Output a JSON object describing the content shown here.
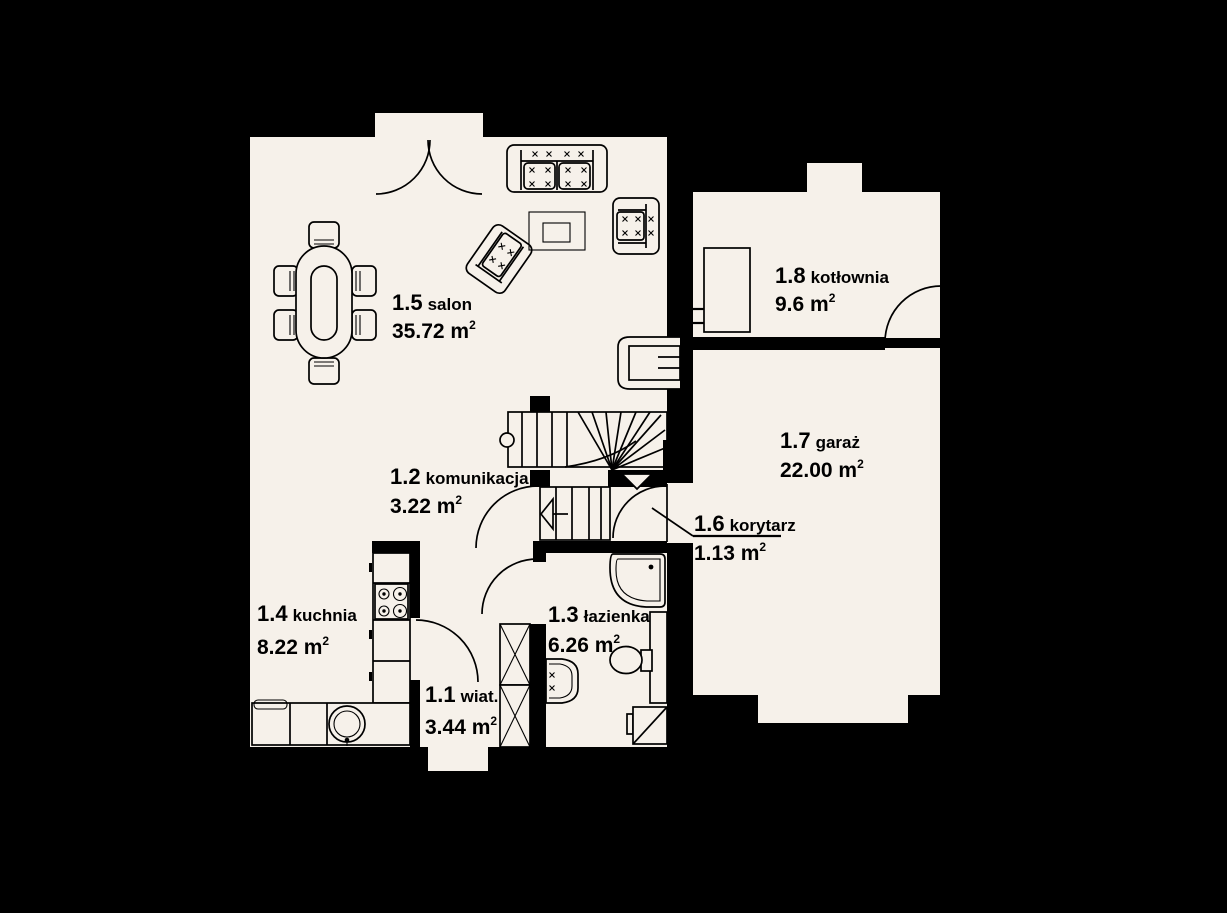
{
  "plan": {
    "title": "floor-plan-ground-floor",
    "colors": {
      "bg": "#000000",
      "floor": "#f6f1ea",
      "line": "#000000"
    },
    "rooms": [
      {
        "number": "1.1",
        "name": "wiat.",
        "area": "3.44 m",
        "area_sup": "2"
      },
      {
        "number": "1.2",
        "name": "komunikacja",
        "area": "3.22 m",
        "area_sup": "2"
      },
      {
        "number": "1.3",
        "name": "łazienka",
        "area": "6.26 m",
        "area_sup": "2"
      },
      {
        "number": "1.4",
        "name": "kuchnia",
        "area": "8.22 m",
        "area_sup": "2"
      },
      {
        "number": "1.5",
        "name": "salon",
        "area": "35.72 m",
        "area_sup": "2"
      },
      {
        "number": "1.6",
        "name": "korytarz",
        "area": "1.13 m",
        "area_sup": "2"
      },
      {
        "number": "1.7",
        "name": "garaż",
        "area": "22.00 m",
        "area_sup": "2"
      },
      {
        "number": "1.8",
        "name": "kotłownia",
        "area": "9.6 m",
        "area_sup": "2"
      }
    ],
    "furniture": [
      "dining-table-with-six-chairs",
      "sofa",
      "armchair",
      "rotated-armchair",
      "coffee-table-with-rug",
      "fireplace",
      "staircase-upper-flight",
      "staircase-lower-flight",
      "entrance-arrow",
      "kitchen-counter",
      "cooktop",
      "kitchen-sink",
      "wardrobe",
      "shower",
      "toilet",
      "washbasin",
      "washing-machine",
      "boiler",
      "door-swings"
    ]
  }
}
